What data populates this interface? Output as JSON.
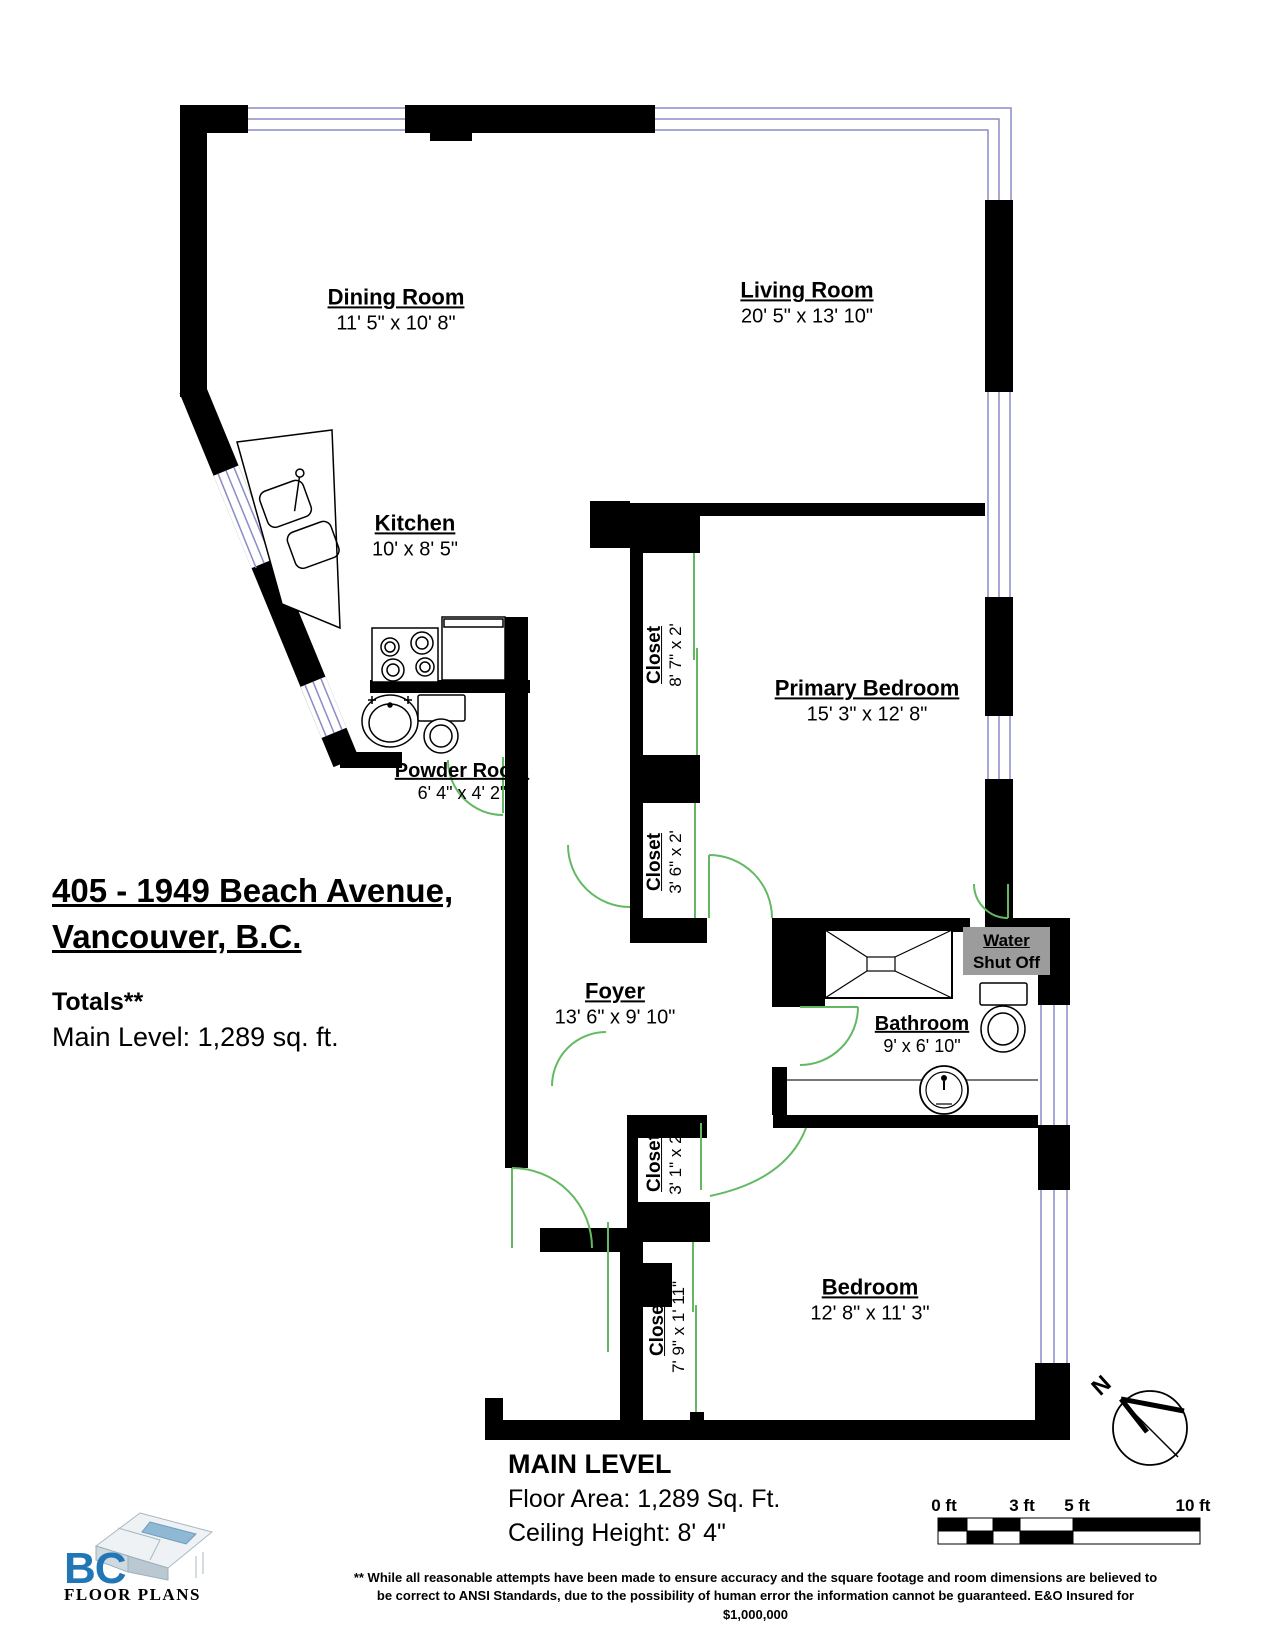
{
  "plan": {
    "address_line1": "405 - 1949 Beach Avenue,",
    "address_line2": "Vancouver, B.C.",
    "totals_heading": "Totals**",
    "totals_main_level": "Main Level: 1,289 sq. ft.",
    "level_title": "MAIN LEVEL",
    "level_floor_area": "Floor Area: 1,289 Sq. Ft.",
    "level_ceiling": "Ceiling Height: 8' 4\""
  },
  "rooms": [
    {
      "name": "Dining Room",
      "dims": "11' 5\" x 10' 8\""
    },
    {
      "name": "Living Room",
      "dims": "20' 5\" x 13' 10\""
    },
    {
      "name": "Kitchen",
      "dims": "10' x 8' 5\""
    },
    {
      "name": "Powder Room",
      "dims": "6' 4\" x 4' 2\""
    },
    {
      "name": "Primary Bedroom",
      "dims": "15' 3\" x 12' 8\""
    },
    {
      "name": "Foyer",
      "dims": "13' 6\" x 9' 10\""
    },
    {
      "name": "Bathroom",
      "dims": "9' x 6' 10\""
    },
    {
      "name": "Bedroom",
      "dims": "12' 8\" x 11' 3\""
    }
  ],
  "closets": [
    {
      "name": "Closet",
      "dims": "8' 7\" x 2'"
    },
    {
      "name": "Closet",
      "dims": "3' 6\" x 2'"
    },
    {
      "name": "Closet",
      "dims": "3' 1\" x 2'"
    },
    {
      "name": "Closet",
      "dims": "7' 9\" x 1' 11\""
    }
  ],
  "water_shutoff": {
    "line1": "Water",
    "line2": "Shut Off"
  },
  "north_label": "N",
  "scale_bar": {
    "labels": [
      "0 ft",
      "3 ft",
      "5 ft",
      "10 ft"
    ]
  },
  "logo": {
    "bc": "BC",
    "text": "FLOOR PLANS"
  },
  "disclaimer": {
    "line1": "** While all reasonable attempts have been made to ensure accuracy and the square footage and room dimensions are believed to",
    "line2": "be correct to ANSI Standards, due to the possibility of human error the information cannot be guaranteed. E&O Insured for $1,000,000"
  },
  "colors": {
    "wall": "#000000",
    "window": "#8b8bc8",
    "door": "#63b963",
    "shutoff_bg": "#9c9c9c",
    "logo_blue": "#2176b5"
  }
}
